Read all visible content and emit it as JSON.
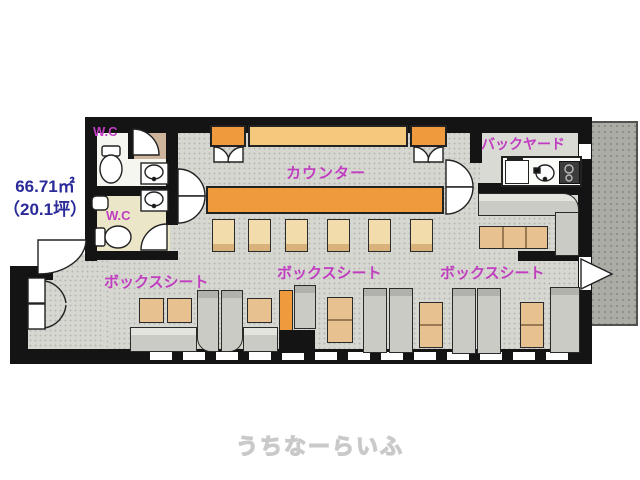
{
  "plan": {
    "type": "restaurant-floor-plan",
    "area": {
      "sqm": "66.71㎡",
      "tsubo": "（20.1坪）"
    },
    "rooms": {
      "wc_upper": {
        "label": "W.C"
      },
      "wc_lower": {
        "label": "W.C"
      },
      "counter": {
        "label": "カウンター"
      },
      "backyard": {
        "label": "バックヤード"
      },
      "box_seat_left": {
        "label": "ボックスシート"
      },
      "box_seat_center": {
        "label": "ボックスシート"
      },
      "box_seat_right": {
        "label": "ボックスシート"
      }
    },
    "fixtures": [
      "toilet",
      "toilet",
      "wash-basin",
      "wash-basin",
      "hand-sink",
      "refrigerator",
      "kitchen-sink",
      "stove"
    ],
    "colors": {
      "label_magenta": "#c03cc0",
      "area_blue": "#2a2a99",
      "counter_orange": "#f09a3e",
      "shelf_tan": "#f6c87e",
      "stool_tan": "#f3dcab",
      "table_tan": "#e8c191",
      "bench_gray": "#cbcbc6",
      "floor_gray": "#d7d7d1",
      "wall_black": "#141414",
      "hatch_gray": "#acaca6"
    }
  },
  "watermark": {
    "text": "うちなーらいふ"
  }
}
